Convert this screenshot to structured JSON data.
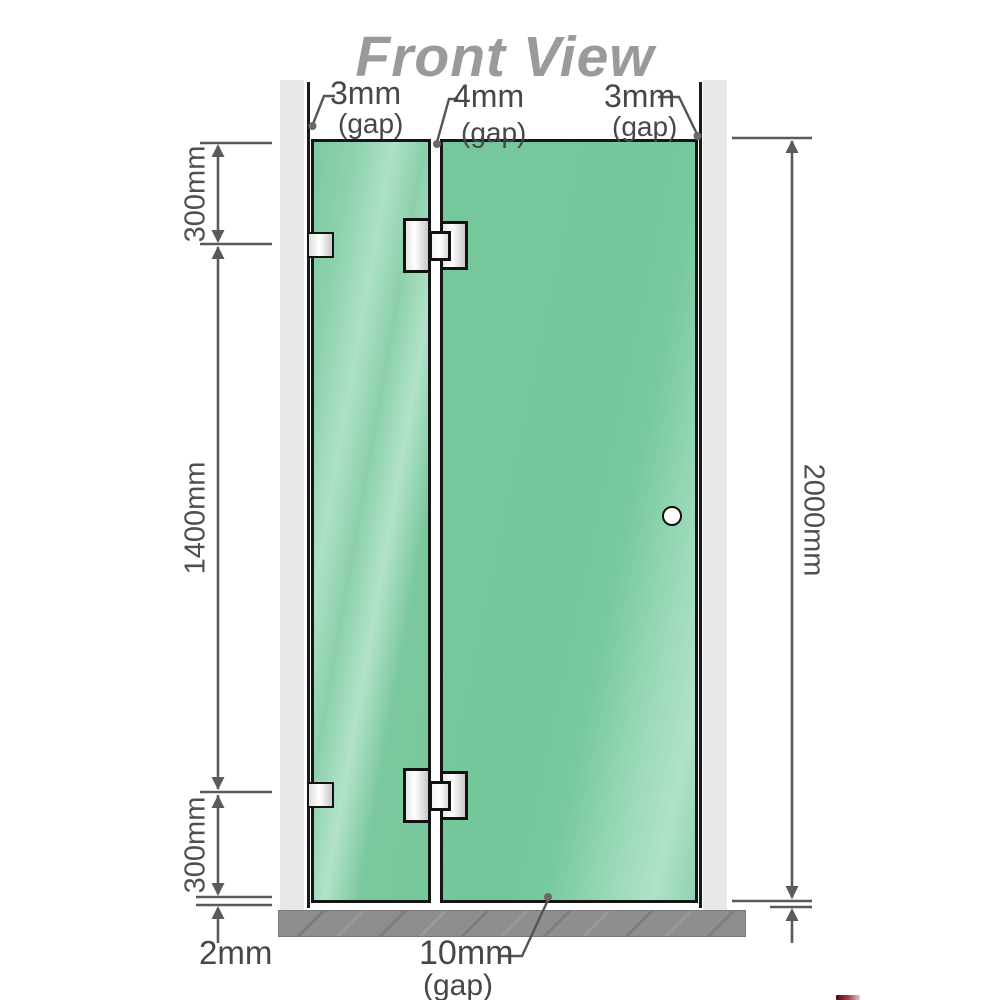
{
  "title": "Front View",
  "gap_annotations": {
    "top_left": {
      "value": "3mm",
      "label": "(gap)"
    },
    "top_middle": {
      "value": "4mm",
      "label": "(gap)"
    },
    "top_right": {
      "value": "3mm",
      "label": "(gap)"
    },
    "bottom": {
      "value": "10mm",
      "label": "(gap)"
    },
    "bottom_left_floor": {
      "value": "2mm"
    }
  },
  "dimensions": {
    "left_top": "300mm",
    "left_middle": "1400mm",
    "left_bottom": "300mm",
    "right_overall": "2000mm"
  },
  "colors": {
    "glass_green": "#77c89d",
    "glass_highlight": "#b2e3cb",
    "wall_gray": "#e8e8e8",
    "floor_gray": "#8e8e8e",
    "outline_dark": "#1a1a1a",
    "dimension_gray": "#5a5a5a",
    "title_gray": "#9a9a9a"
  }
}
